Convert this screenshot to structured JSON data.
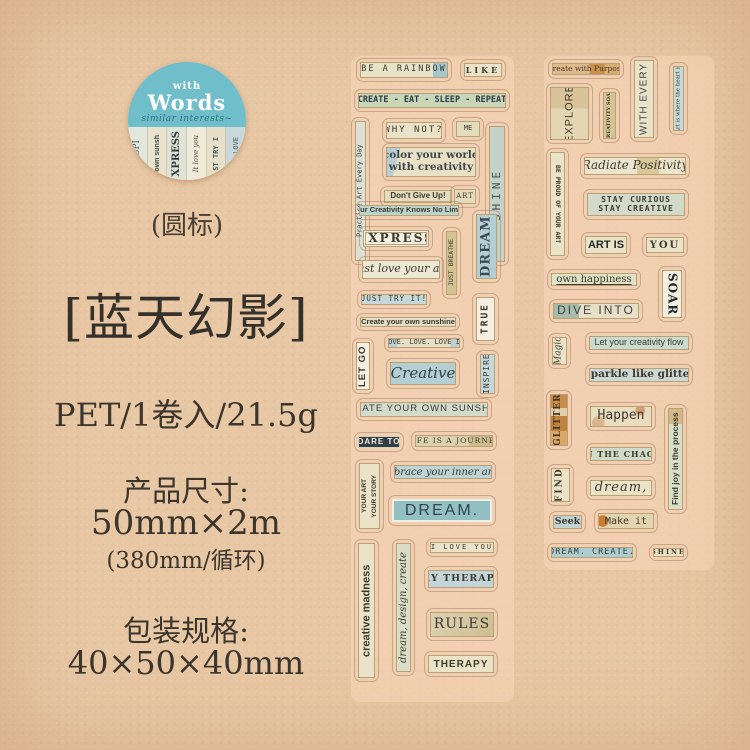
{
  "colors": {
    "paper": "#e8c7a4",
    "logo_teal": "#6fbec9",
    "ink": "#3b352c",
    "label_blue": "#92c0c5",
    "label_dark": "#333d47"
  },
  "logo": {
    "with": "with",
    "words": "Words",
    "subtitle": "similar interests~",
    "strips": [
      "INSPI",
      "own sunsh",
      "XPRESS",
      "It love you",
      "ST TRY I",
      "VE. LOVE"
    ],
    "caption": "(圆标)"
  },
  "product": {
    "title": "[蓝天幻影]",
    "spec": "PET/1卷入/21.5g",
    "size_label": "产品尺寸:",
    "size_value": "50mm×2m",
    "size_note": "(380mm/循环)",
    "package_label": "包装规格:",
    "package_value": "40×50×40mm"
  },
  "sheets": {
    "left": {
      "be_a_rainbow": "BE A RAINBOW",
      "like": "LIKE",
      "create_eat_sleep_repeat": "CREATE - EAT - SLEEP - REPEAT",
      "practice_art": "Practice Art Every Day",
      "why_not": "WHY NOT?",
      "me": "ME",
      "shine": "SHINE",
      "color_world_1": "color your world",
      "color_world_2": "with creativity",
      "dont_give_up": "Don't Give Up!",
      "art": "ART",
      "creativity_no_limits": "Your Creativity Knows No Limits",
      "express": "EXPRESS",
      "just_love_your_art": "Just love your art",
      "just_breathe": "JUST BREATHE",
      "dream_v": "DREAM",
      "just_try_it": "JUST TRY IT!",
      "create_sunshine_sm": "Create your own sunshine",
      "true_word": "TRUE",
      "let_go": "LET GO",
      "love_love": "LOVE. LOVE. LOVE IT",
      "creative": "Creative",
      "inspire": "INSPIRE",
      "create_sunshine_lg": "CREATE YOUR OWN SUNSHINE",
      "dare_to": "DARE TO",
      "life_journey": "LIFE IS A JOURNEY",
      "your_art_1": "YOUR ART",
      "your_art_2": "YOUR STORY",
      "embrace": "Embrace your inner artist",
      "dream_lg": "DREAM.",
      "creative_madness": "creative madness",
      "dream_design_create": "dream, design, create",
      "i_love_you": "I LOVE YOU",
      "my_therapy": "MY THERAPY",
      "rules": "RULES",
      "therapy": "THERAPY"
    },
    "right": {
      "create_with_purpose": "Create with Purpose",
      "with_every": "WITH EVERY",
      "art_heart": "Art is where the heart is",
      "explore": "EXPLORE",
      "creativity_soar": "CREATIVITY SOAR",
      "be_proud": "BE PROUD OF YOUR ART",
      "radiate": "Radiate Positivity",
      "stay_curious_1": "STAY CURIOUS",
      "stay_curious_2": "STAY CREATIVE",
      "art_is": "ART IS",
      "you": "YOU",
      "own_happiness": "own happiness",
      "soar": "SOAR",
      "dive_into": "DIVE INTO",
      "magic": "Magic",
      "let_flow": "Let your creativity flow",
      "sparkle": "Sparkle like glitter",
      "glitter": "GLITTER",
      "happen": "Happen",
      "find_joy": "Find joy in the process",
      "in_the_chaos": "IN THE CHAOS",
      "find": "FIND",
      "dream_comma": "dream,",
      "seek": "Seek",
      "make_it": "Make it",
      "dream_create": "DREAM. CREATE.",
      "shine_sm": "SHINE"
    }
  }
}
